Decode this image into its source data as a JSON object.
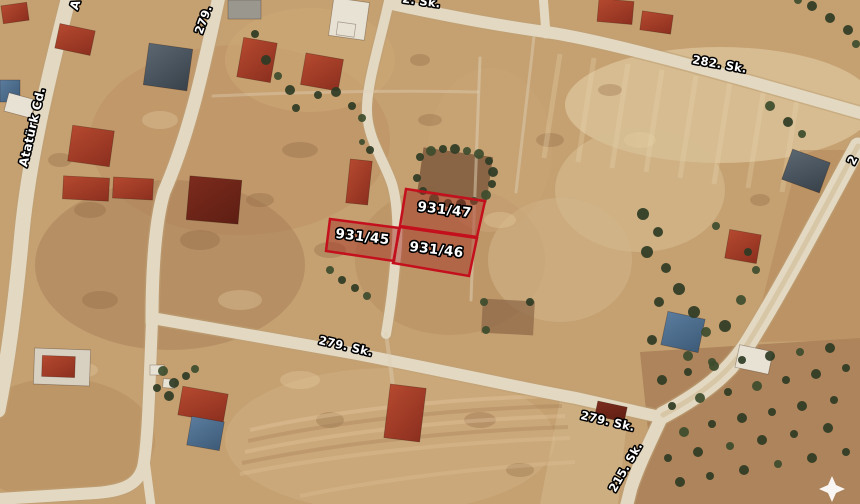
{
  "map": {
    "name": "satellite-parcel-map",
    "view": "aerial",
    "parcel_fill_color": "rgba(165,42,34,0.45)",
    "parcel_border_color": "#c40f1d",
    "label_text_color": "#ffffff",
    "label_outline_color": "#000000"
  },
  "parcels": [
    {
      "label": "931/45",
      "points": "330,219 399,228 394,261 326,251",
      "label_x": 362,
      "label_y": 241,
      "rotation": 7
    },
    {
      "label": "931/46",
      "points": "400,227 477,238 469,276 393,263",
      "label_x": 436,
      "label_y": 254,
      "rotation": 7
    },
    {
      "label": "931/47",
      "points": "406,189 485,201 477,237 400,226",
      "label_x": 444,
      "label_y": 214,
      "rotation": 7
    }
  ],
  "street_labels": [
    {
      "text": "Atatürk Cd.",
      "x": 36,
      "y": 128,
      "rotation": -77,
      "size": 12
    },
    {
      "text": "A",
      "x": 79,
      "y": 6,
      "rotation": -72,
      "size": 12
    },
    {
      "text": "279.",
      "x": 207,
      "y": 21,
      "rotation": -70,
      "size": 11.5
    },
    {
      "text": "2. Sk.",
      "x": 421,
      "y": 5,
      "rotation": 8,
      "size": 11.5
    },
    {
      "text": "282. Sk.",
      "x": 719,
      "y": 68,
      "rotation": 10,
      "size": 11.5
    },
    {
      "text": "279. Sk.",
      "x": 345,
      "y": 350,
      "rotation": 13,
      "size": 11.5
    },
    {
      "text": "279. Sk.",
      "x": 607,
      "y": 425,
      "rotation": 13,
      "size": 11.5
    },
    {
      "text": "215. Sk.",
      "x": 629,
      "y": 469,
      "rotation": -60,
      "size": 11.5
    },
    {
      "text": "2",
      "x": 856,
      "y": 162,
      "rotation": -62,
      "size": 12
    }
  ],
  "watermark": {
    "shape": "four-point-star",
    "x": 832,
    "y": 489,
    "color": "#ffffff"
  }
}
